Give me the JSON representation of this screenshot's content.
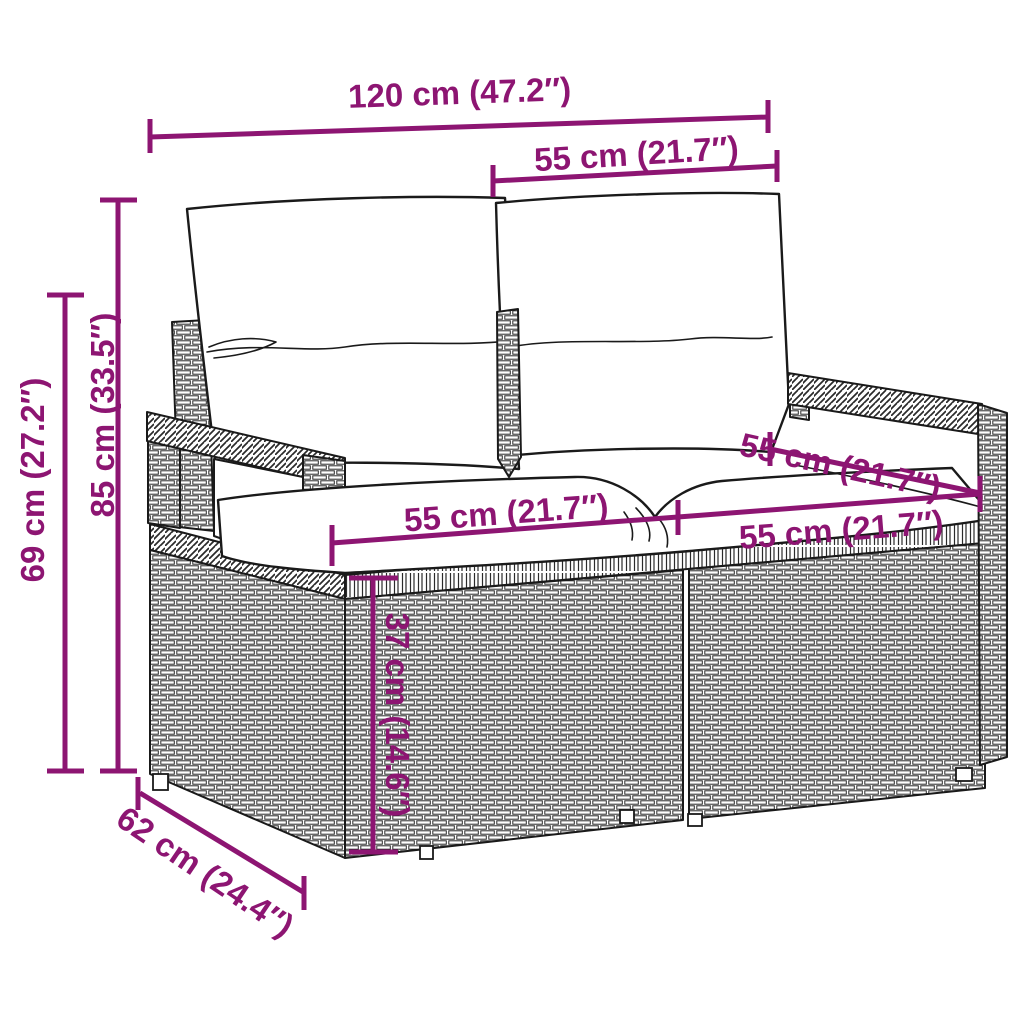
{
  "product": {
    "name": "poly-rattan garden loveseat with cushions",
    "view": "dimension diagram"
  },
  "colors": {
    "dimension_annotation": "#8D1572",
    "line_art": "#1a1a1a",
    "background": "#ffffff"
  },
  "dims": [
    {
      "id": "overall-width",
      "text": "120 cm (47.2″)"
    },
    {
      "id": "backrest-section-width",
      "text": "55 cm (21.7″)"
    },
    {
      "id": "overall-height",
      "text": "85 cm (33.5″)"
    },
    {
      "id": "armrest-height",
      "text": "69 cm (27.2″)"
    },
    {
      "id": "seat-section-width-left",
      "text": "55 cm (21.7″)"
    },
    {
      "id": "seat-section-width-right",
      "text": "55 cm (21.7″)"
    },
    {
      "id": "seat-depth-top",
      "text": "55 cm (21.7″)"
    },
    {
      "id": "seat-height",
      "text": "37 cm (14.6″)"
    },
    {
      "id": "base-depth",
      "text": "62 cm (24.4″)"
    }
  ]
}
